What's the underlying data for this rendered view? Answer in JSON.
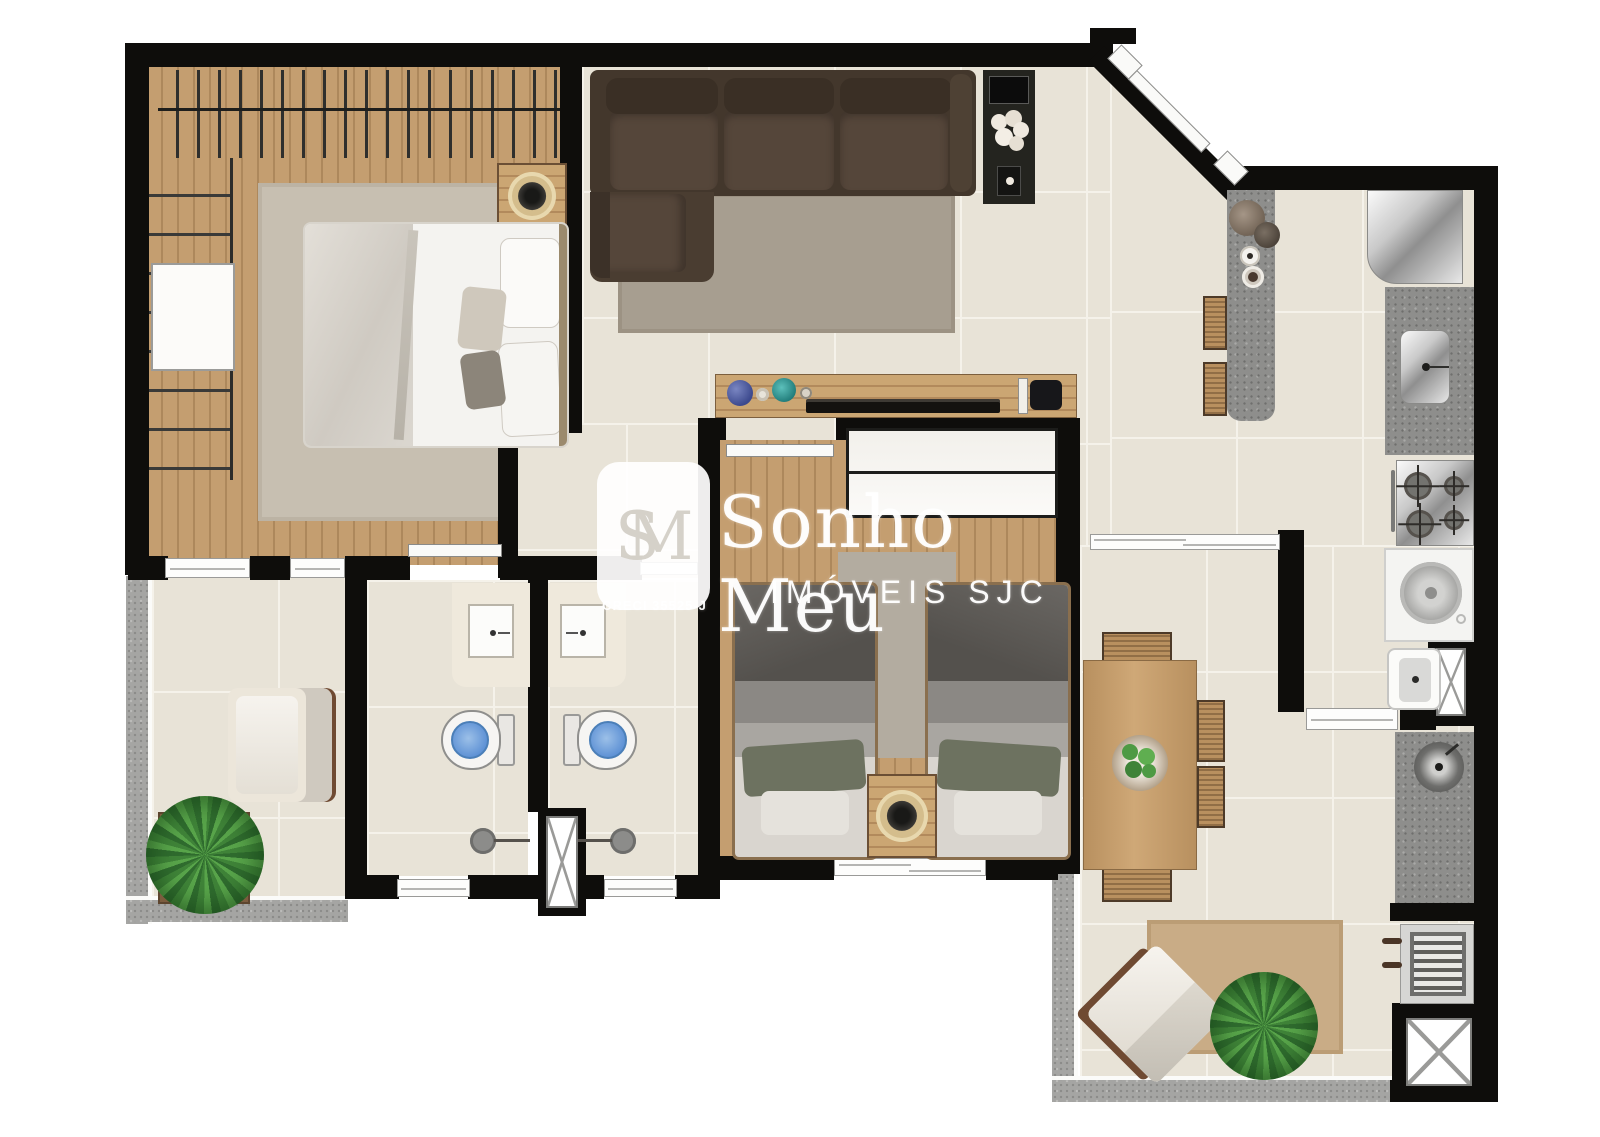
{
  "document": {
    "kind": "apartment-floor-plan",
    "view": "top-down-3d-render"
  },
  "watermark": {
    "monogram": "SM",
    "brand": "Sonho Meu",
    "subtitle": "IMÓVEIS SJC",
    "license": "CRECI 35525-J"
  },
  "palette": {
    "wall": "#0e0d0b",
    "tile": "#e8e3d7",
    "grout": "#f5f2ea",
    "wood_floor": "#c49e70",
    "granite_counter": "#8e8e8c",
    "granite_ledge": "#a5a5a3",
    "sofa_brown": "#4c3e32",
    "living_rug": "#a79e90",
    "bedroom_rug": "#c7bfb1",
    "balcony_rug": "#c9ac86",
    "bed_linen": "#f4f3f0",
    "twin_bed_blanket": "#6a6763",
    "pillow_green": "#6d7260",
    "toilet_water": "#6fa0d8",
    "plant_green": "#3f8338",
    "lamp_gold": "#d4bd8c"
  },
  "rooms": [
    "suite-bedroom",
    "walk-in-closet",
    "suite-bathroom",
    "bathroom-2",
    "living-room",
    "hallway",
    "bedroom-2",
    "kitchen",
    "service-area",
    "dining-area",
    "gourmet-balcony",
    "side-balcony"
  ],
  "furniture_icons": [
    "double-bed-icon",
    "hanger-rack-icon",
    "closet-shelves-icon",
    "nightstand-lamp-icon",
    "sectional-sofa-icon",
    "area-rug-icon",
    "tv-console-icon",
    "flower-vase-icon",
    "sideboard-icon",
    "wall-tv-icon",
    "media-box-icon",
    "twin-bed-icon",
    "wardrobe-icon",
    "vanity-sink-icon",
    "toilet-icon",
    "shower-head-icon",
    "duct-shaft-icon",
    "kitchen-island-icon",
    "bar-stool-icon",
    "refrigerator-icon",
    "kitchen-sink-icon",
    "cooktop-icon",
    "washing-machine-icon",
    "laundry-tub-icon",
    "round-sink-icon",
    "barbecue-grill-icon",
    "dining-table-icon",
    "dining-chair-icon",
    "fruit-bowl-icon",
    "lounge-chair-icon",
    "armchair-icon",
    "potted-plant-icon",
    "sliding-door-icon",
    "entry-door-icon",
    "window-icon",
    "door-leaf-icon"
  ]
}
